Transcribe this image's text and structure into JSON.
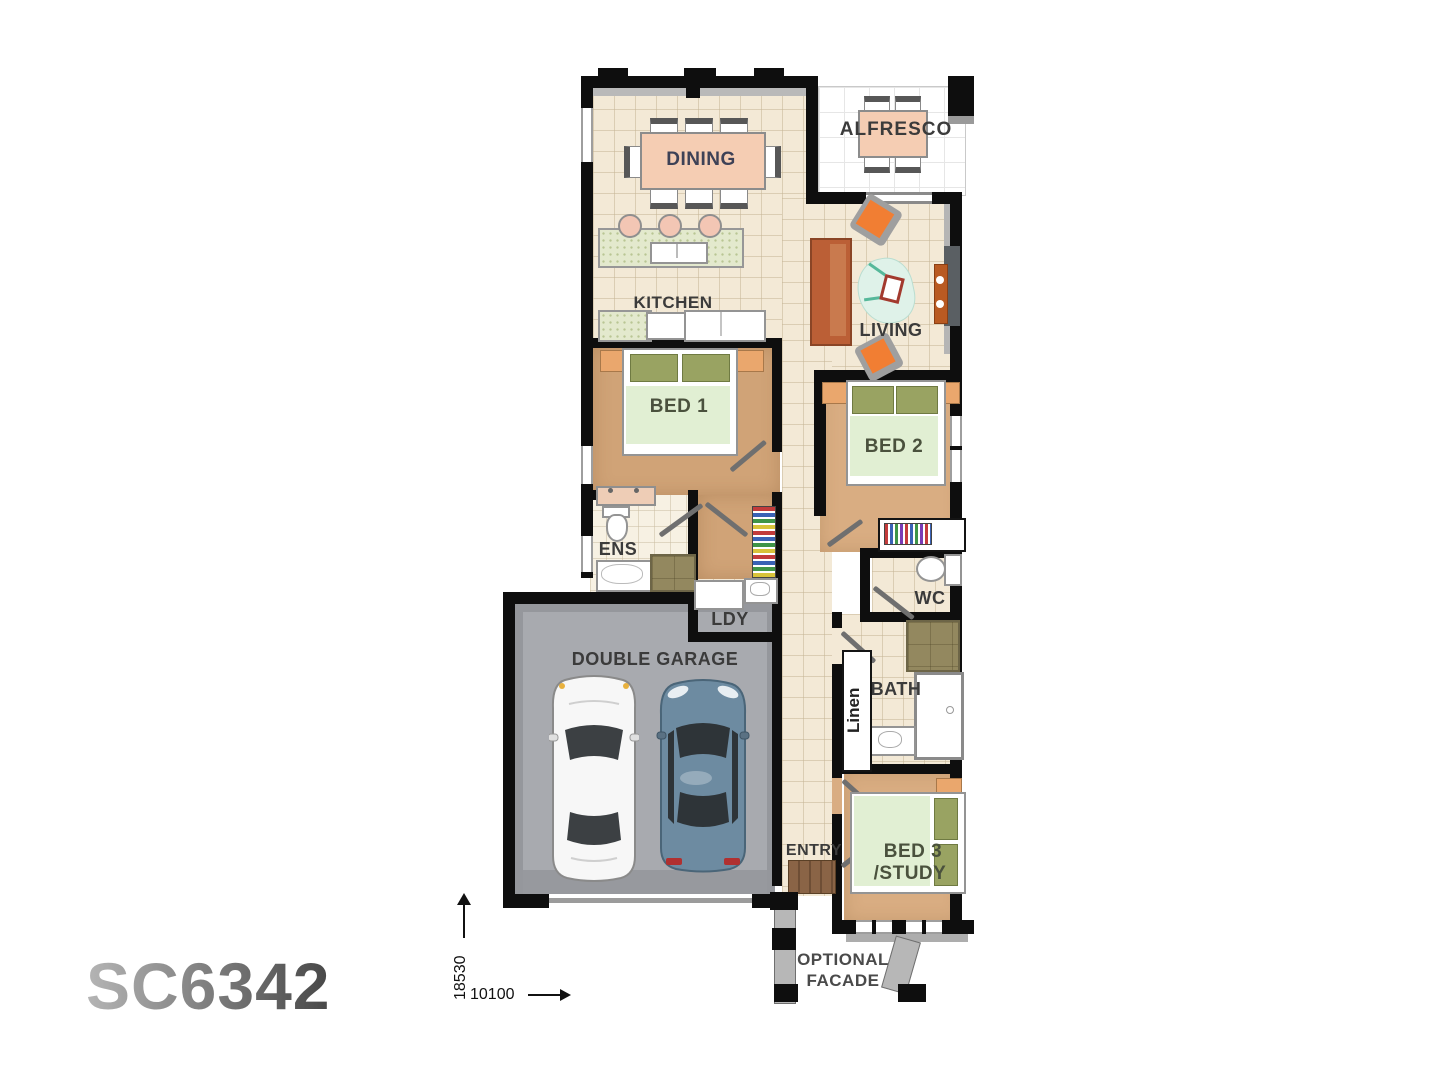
{
  "logo": {
    "text": "SC6342"
  },
  "rooms": {
    "dining": "DINING",
    "alfresco": "ALFRESCO",
    "kitchen": "KITCHEN",
    "living": "LIVING",
    "bed1": "BED 1",
    "bed2": "BED 2",
    "ens": "ENS",
    "ldy": "LDY",
    "wc": "WC",
    "garage": "DOUBLE GARAGE",
    "bath": "BATH",
    "linen": "Linen",
    "entry": "ENTRY",
    "bed3_line1": "BED 3",
    "bed3_line2": "/STUDY"
  },
  "annotations": {
    "facade_line1": "OPTIONAL",
    "facade_line2": "FACADE",
    "dim_vertical": "18530",
    "dim_horizontal": "10100"
  },
  "colors": {
    "tile_floor": "#f3e9d6",
    "carpet": "#d0a377",
    "carpet_light": "#d9ad82",
    "garage_floor": "#a8aaaf",
    "wall": "#0e0e0e",
    "table_salmon": "#f5cdb3",
    "quilt_green": "#e1efd3",
    "pillow_olive": "#99a362",
    "bedside_orange": "#eaa76d",
    "sofa": "#bb5f36",
    "chair_orange": "#f17e33",
    "rug_mint": "#dff2e9",
    "label_text": "#3b3b3b",
    "bed_label": "#4a513d",
    "dining_label": "#3d4156",
    "logo_from": "#b5b5b5",
    "logo_to": "#474747"
  }
}
